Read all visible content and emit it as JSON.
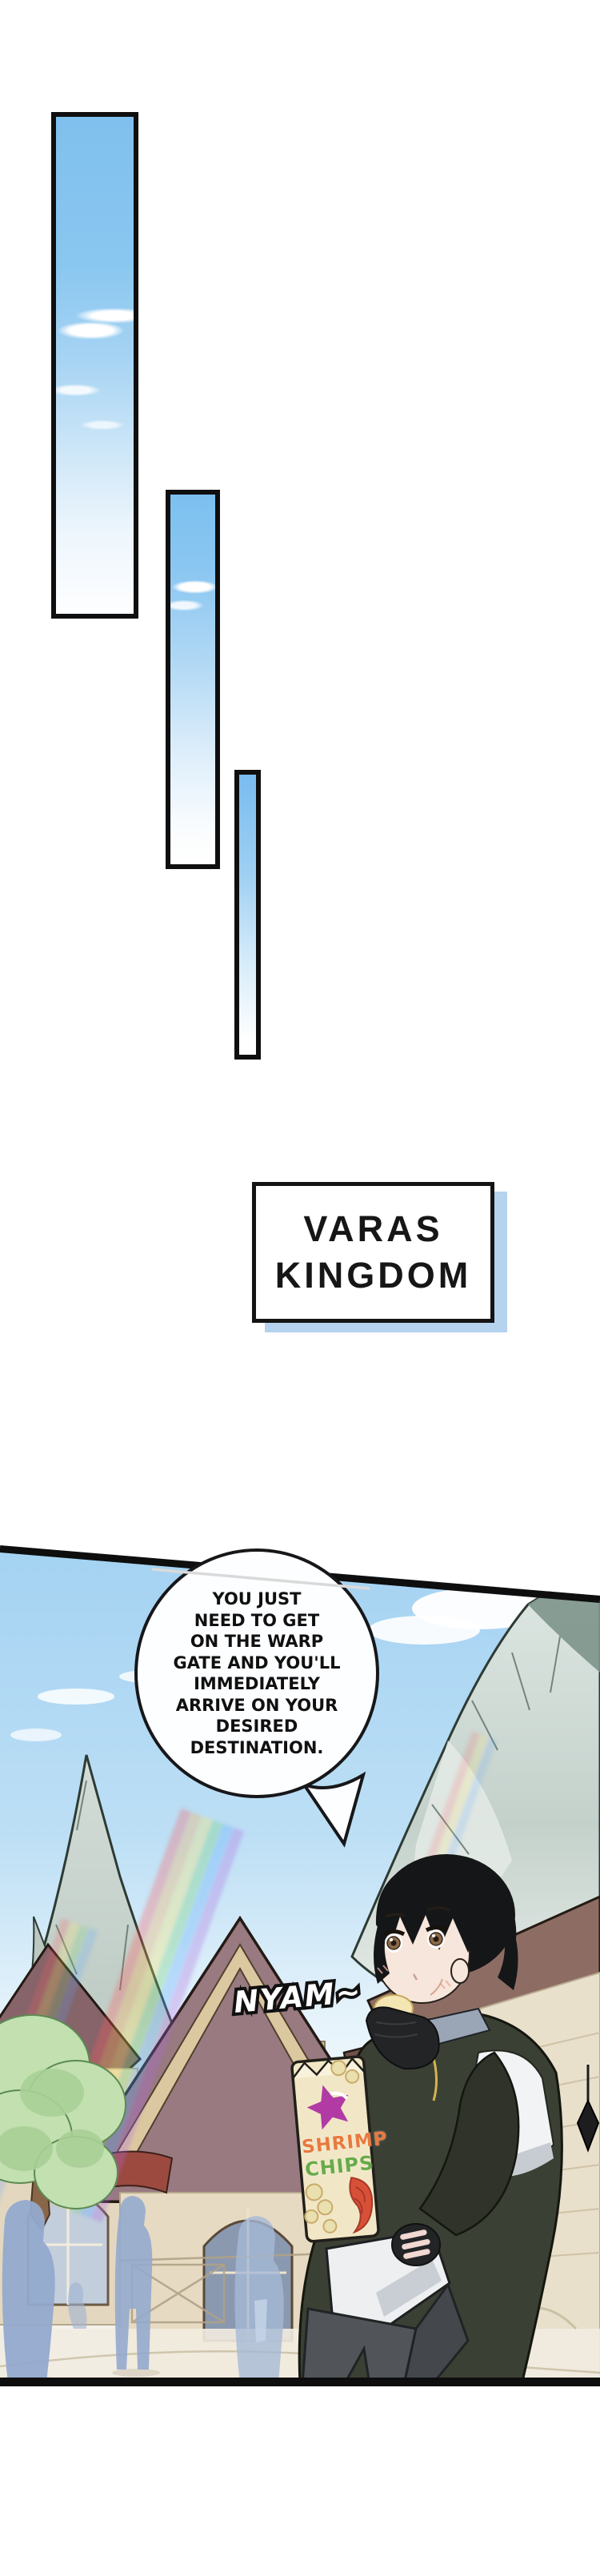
{
  "caption_box": {
    "line1": "VARAS",
    "line2": "KINGDOM"
  },
  "speech_bubble": {
    "lines": [
      "YOU JUST",
      "NEED TO GET",
      "ON THE WARP",
      "GATE AND YOU'LL",
      "IMMEDIATELY",
      "ARRIVE ON YOUR",
      "DESIRED",
      "DESTINATION."
    ]
  },
  "sfx": {
    "eating": "NYAM~"
  },
  "chips_bag": {
    "line1": "SHRIMP",
    "line2": "CHIPS"
  },
  "colors": {
    "panel_border": "#0f0f0f",
    "sky_blue": "#7fc0ee",
    "caption_shadow_blue": "#b5d2ee",
    "bag_cream": "#f1e7c6",
    "star_magenta": "#b13aa5",
    "shrimp_text_orange": "#e8793f",
    "chips_text_green": "#67ab4a",
    "shrimp_art_red": "#d85038",
    "silhouette_blue": "#94aacd",
    "mountain_gray": "#ccd6d0",
    "roof_mauve": "#997a80",
    "wall_cream": "#e7dac2"
  }
}
